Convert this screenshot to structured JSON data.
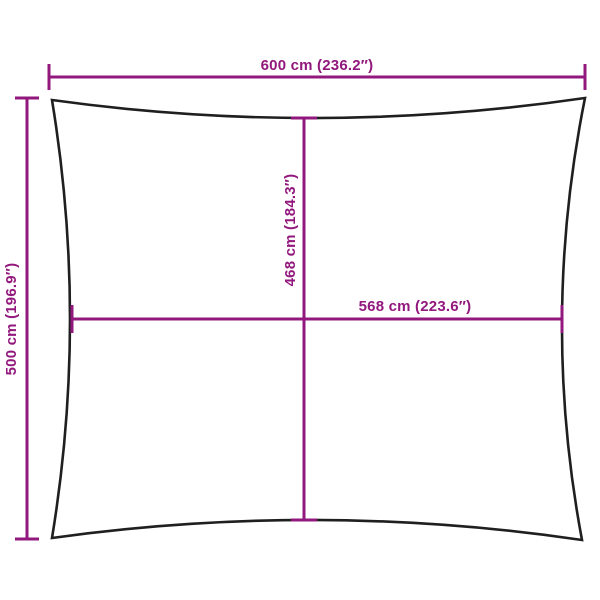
{
  "diagram": {
    "description": "shade-sail-dimension-diagram",
    "labels": {
      "top_width": "600 cm (236.2″)",
      "left_height": "500 cm (196.9″)",
      "center_vertical": "468 cm (184.3″)",
      "center_horizontal": "568 cm (223.6″)"
    },
    "colors": {
      "dimension": "#92187d",
      "outline": "#1f1f1f",
      "background": "#ffffff"
    }
  }
}
